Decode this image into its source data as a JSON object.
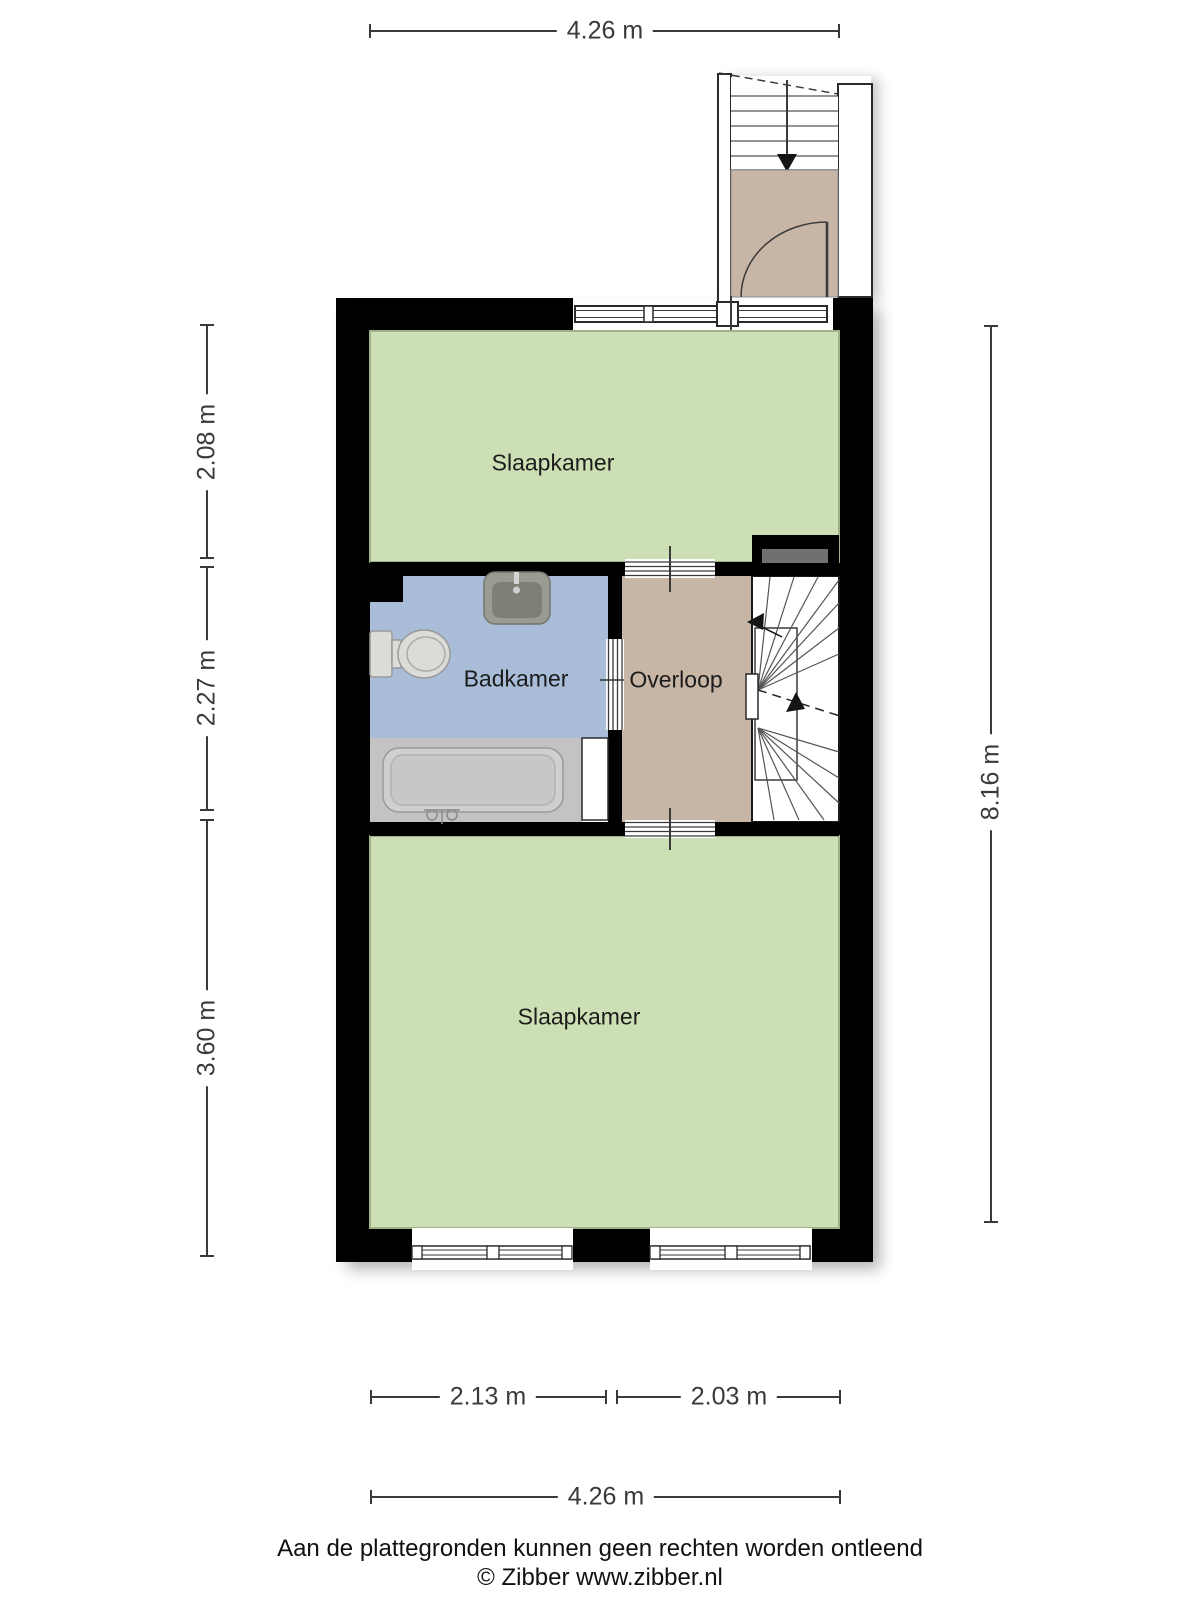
{
  "plan": {
    "rooms": [
      {
        "id": "slaapkamer-top",
        "label": "Slaapkamer"
      },
      {
        "id": "badkamer",
        "label": "Badkamer"
      },
      {
        "id": "overloop",
        "label": "Overloop"
      },
      {
        "id": "slaapkamer-bottom",
        "label": "Slaapkamer"
      }
    ],
    "dimensions": {
      "top_width": "4.26 m",
      "left_top": "2.08 m",
      "left_middle": "2.27 m",
      "left_bottom": "3.60 m",
      "right_total": "8.16 m",
      "bottom_left": "2.13 m",
      "bottom_right": "2.03 m",
      "bottom_total": "4.26 m"
    },
    "colors": {
      "bg": "#ffffff",
      "wall": "#000000",
      "bedroom": "#cddfb4",
      "bedroom_border": "#9fb286",
      "bathroom": "#a9bdd9",
      "landing": "#c7b6a5",
      "tubzone": "#c3c3c3",
      "fixture": "#dbdbd7",
      "sink_outer": "#9a9b93",
      "sink_inner": "#7e7f75",
      "inset": "#707070",
      "line": "#3a3a3a",
      "text": "#1c1c1c"
    }
  },
  "footer": {
    "disclaimer": "Aan de plattegronden kunnen geen rechten worden ontleend",
    "copyright": "© Zibber www.zibber.nl"
  }
}
